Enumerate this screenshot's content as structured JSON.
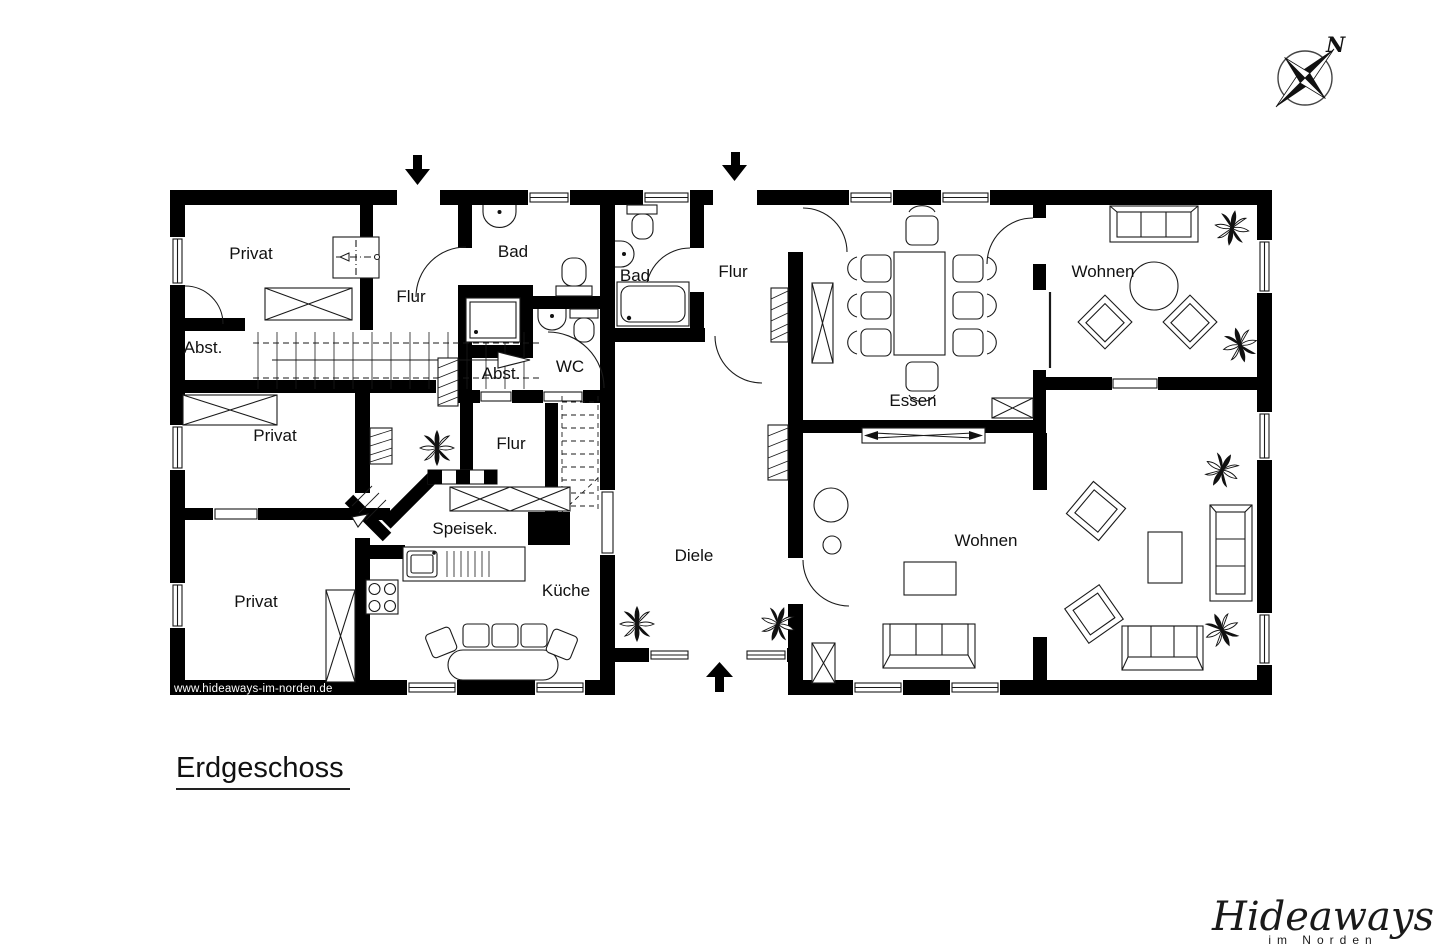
{
  "plan": {
    "title": "Erdgeschoss",
    "watermark": "www.hideaways-im-norden.de",
    "compass_north": "N",
    "rooms": [
      {
        "id": "privat-1",
        "label": "Privat"
      },
      {
        "id": "abst-1",
        "label": "Abst."
      },
      {
        "id": "privat-2",
        "label": "Privat"
      },
      {
        "id": "privat-3",
        "label": "Privat"
      },
      {
        "id": "flur-1",
        "label": "Flur"
      },
      {
        "id": "bad-1",
        "label": "Bad"
      },
      {
        "id": "abst-2",
        "label": "Abst."
      },
      {
        "id": "wc",
        "label": "WC"
      },
      {
        "id": "flur-2",
        "label": "Flur"
      },
      {
        "id": "speisekammer",
        "label": "Speisek."
      },
      {
        "id": "kueche",
        "label": "Küche"
      },
      {
        "id": "bad-2",
        "label": "Bad"
      },
      {
        "id": "flur-3",
        "label": "Flur"
      },
      {
        "id": "diele",
        "label": "Diele"
      },
      {
        "id": "essen",
        "label": "Essen"
      },
      {
        "id": "wohnen-1",
        "label": "Wohnen"
      },
      {
        "id": "wohnen-2",
        "label": "Wohnen"
      }
    ]
  },
  "branding": {
    "logo_main": "Hideaways",
    "logo_sub": "im Norden"
  },
  "colors": {
    "wall": "#000000",
    "background": "#ffffff",
    "line": "#1a1a1a"
  }
}
